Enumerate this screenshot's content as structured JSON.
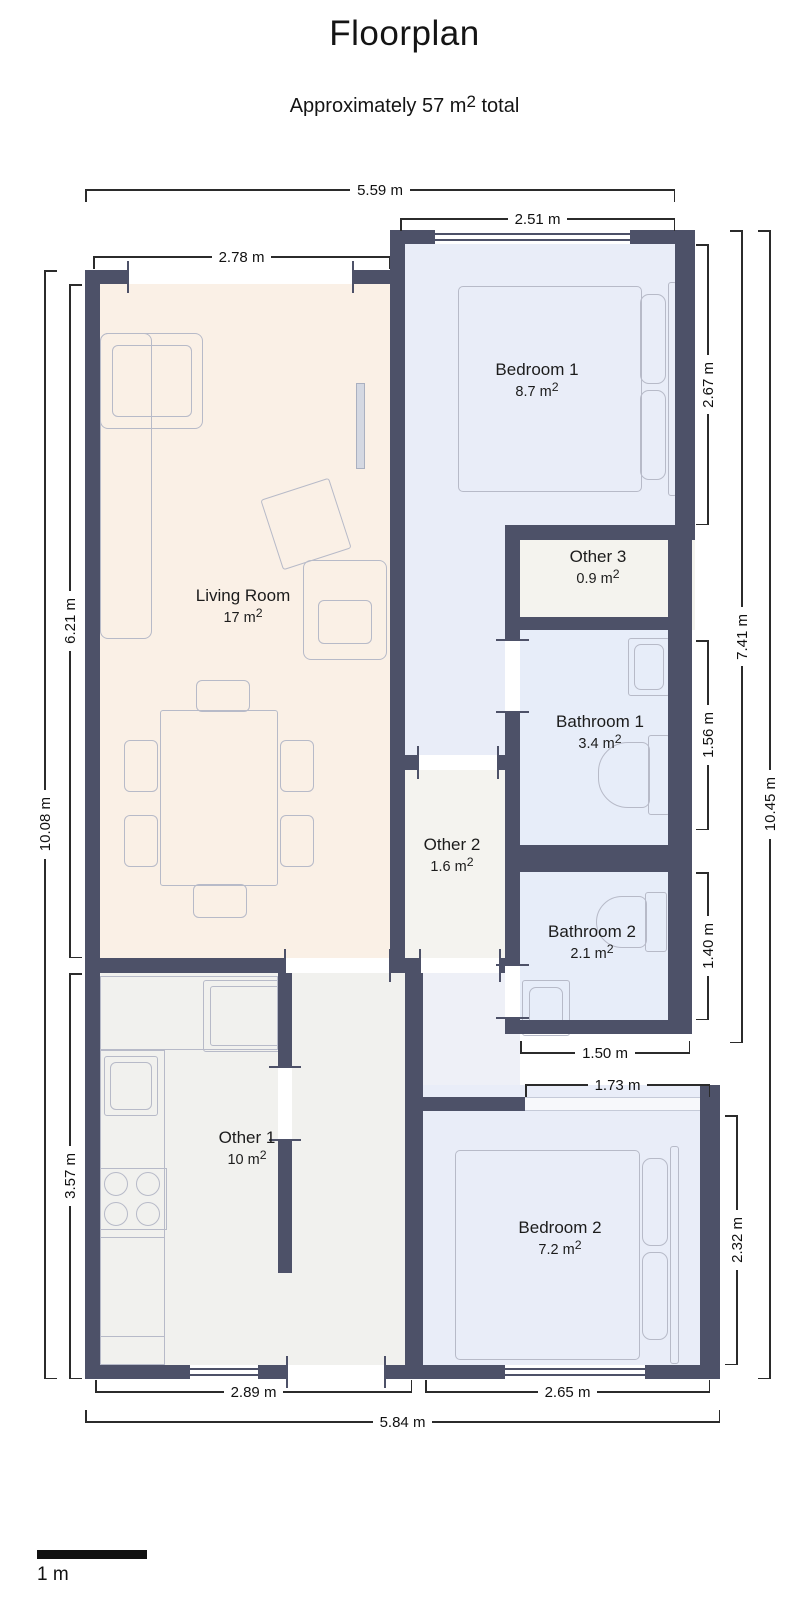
{
  "header": {
    "title": "Floorplan",
    "subtitle_pre": "Approximately 57 m",
    "subtitle_sup": "2",
    "subtitle_post": " total"
  },
  "rooms": {
    "living": {
      "name": "Living Room",
      "area": "17 m",
      "sup": "2"
    },
    "bedroom1": {
      "name": "Bedroom 1",
      "area": "8.7 m",
      "sup": "2"
    },
    "other3": {
      "name": "Other 3",
      "area": "0.9 m",
      "sup": "2"
    },
    "bathroom1": {
      "name": "Bathroom 1",
      "area": "3.4 m",
      "sup": "2"
    },
    "other2": {
      "name": "Other 2",
      "area": "1.6 m",
      "sup": "2"
    },
    "bathroom2": {
      "name": "Bathroom 2",
      "area": "2.1 m",
      "sup": "2"
    },
    "other1": {
      "name": "Other 1",
      "area": "10 m",
      "sup": "2"
    },
    "bedroom2": {
      "name": "Bedroom 2",
      "area": "7.2 m",
      "sup": "2"
    }
  },
  "dimensions": {
    "top_overall": "5.59 m",
    "top_bedroom1": "2.51 m",
    "top_living": "2.78 m",
    "left_overall": "10.08 m",
    "left_living": "6.21 m",
    "left_kitchen": "3.57 m",
    "right_bedroom1": "2.67 m",
    "right_bathroom1": "1.56 m",
    "right_bathroom2": "1.40 m",
    "right_bedroom2": "2.32 m",
    "right_upper": "7.41 m",
    "right_overall": "10.45 m",
    "mid_bathroom2": "1.50 m",
    "mid_bedroom2": "1.73 m",
    "bottom_left": "2.89 m",
    "bottom_right": "2.65 m",
    "bottom_overall": "5.84 m"
  },
  "scale_bar": {
    "label": "1 m"
  },
  "palette": {
    "wall": "#4d5168",
    "living_fill": "#faf0e6",
    "bedroom_fill": "#e9edf8",
    "bathroom_fill": "#e7edf9",
    "other_fill": "#f2f2ee",
    "dimension_line": "#2b2b2b"
  }
}
